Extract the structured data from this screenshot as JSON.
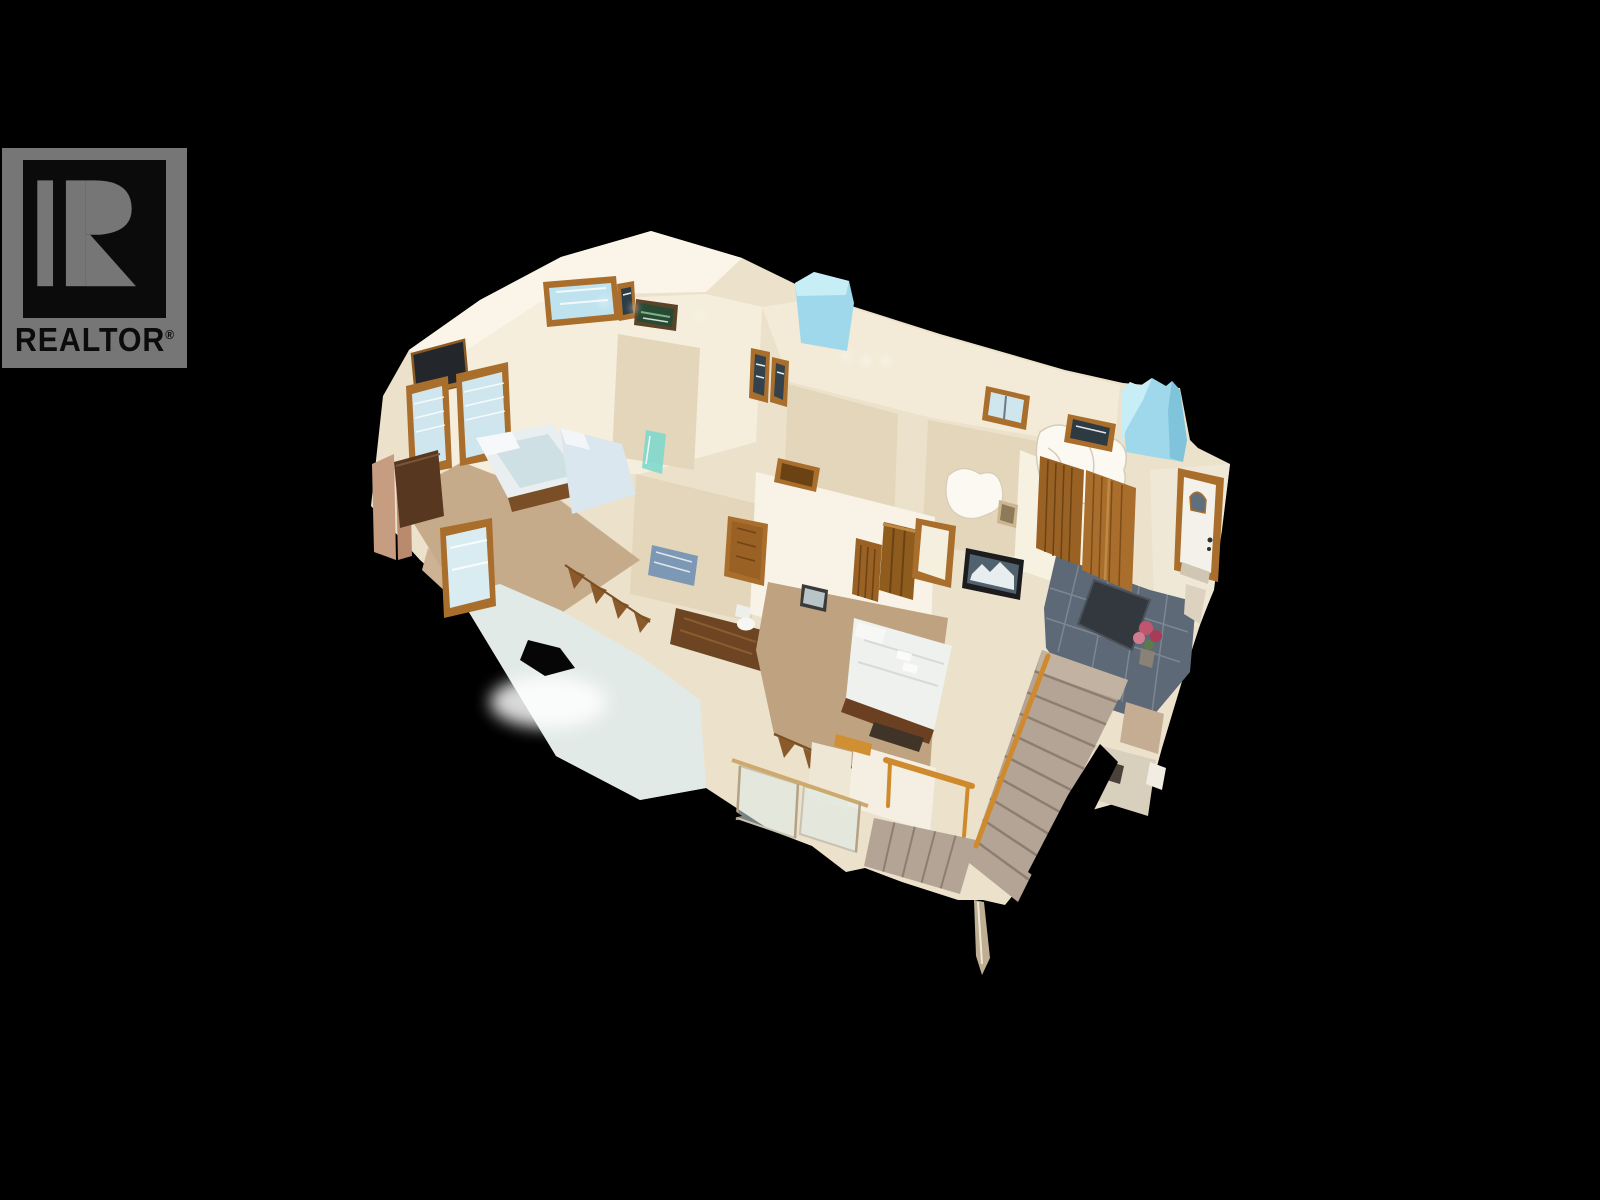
{
  "watermark": {
    "brand": "REALTOR",
    "registered_symbol": "®",
    "logo_letter": "R",
    "badge_color": "#767676",
    "emblem_background": "#0b0b0b",
    "text_color": "#0b0b0b"
  },
  "scene": {
    "type": "3d-dollhouse-tour",
    "description": "Cutaway 3D dollhouse scan of a house upper floor: two bedrooms with wood-trimmed windows, hallway with wooden doors, primary bedroom with white bed and framed art, slate-tiled entry foyer with front door, doormat and flowers, cyan skylight shafts, and a carpeted staircase descending to the lower level, all floating on a black background",
    "background_color": "#000000",
    "palette": {
      "wall_cream": "#ece2cc",
      "wall_bright": "#faf5e8",
      "wall_mid": "#f5eedd",
      "wall_shadow": "#e3d6bb",
      "wood_trim": "#a96e2c",
      "wood_dark": "#6e4522",
      "carpet_tan": "#bfa27f",
      "carpet_stair": "#b4a495",
      "skylight_cyan": "#9ed8ea",
      "skylight_cyan_light": "#c7eef7",
      "slate_tile": "#5d6977",
      "mat_dark": "#33383e",
      "flower_pink": "#c05570",
      "bed_white": "#eff1ee",
      "floor_pale": "#e2eae8",
      "glass_blue": "#cfe6ef",
      "rail_orange": "#cf8a2e"
    }
  }
}
